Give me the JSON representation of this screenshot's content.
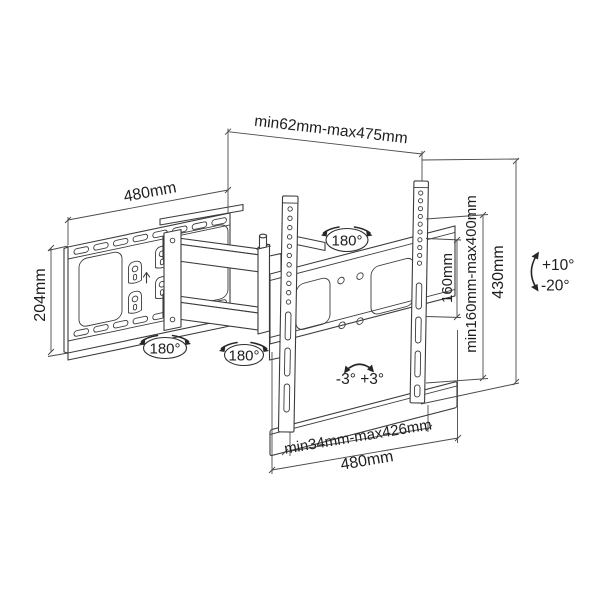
{
  "diagram": {
    "type": "technical-dimension-drawing",
    "subject": "full-motion articulating TV wall mount bracket",
    "colors": {
      "line": "#3b3b3b",
      "dimension_line": "#4a4a4a",
      "text": "#1e1e1e",
      "background": "#ffffff"
    },
    "labels": {
      "extension_range": "min62mm-max475mm",
      "wall_plate_width": "480mm",
      "wall_plate_height": "204mm",
      "swivel_tv": "180°",
      "swivel_wall": "180°",
      "swivel_arm": "180°",
      "vesa_vertical": "160mm",
      "hole_range_vertical": "min160mm-max400mm",
      "bracket_height": "430mm",
      "tilt_up": "+10°",
      "tilt_down": "-20°",
      "level_range": "-3° +3°",
      "hole_range_horizontal": "min34mm-max426mm",
      "bracket_width": "480mm"
    }
  }
}
